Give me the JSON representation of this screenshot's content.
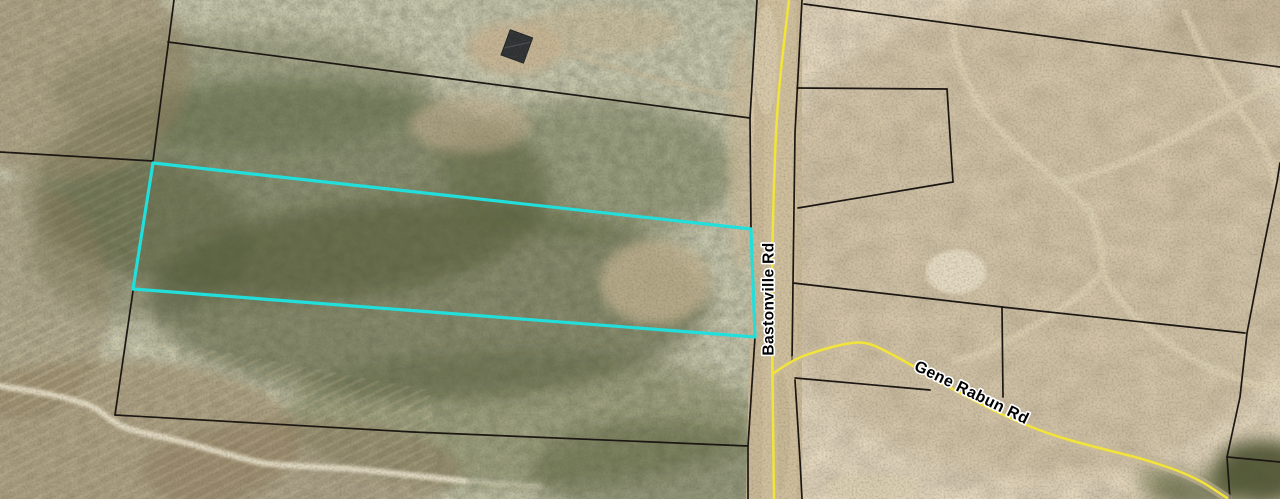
{
  "map": {
    "colors": {
      "parcel_line": "#1c1712",
      "highlight": "#22dfdc",
      "road_centerline": "#f2e438",
      "road_casing": "#cbbb9a"
    },
    "labels": [
      {
        "text": "Bastonville Rd",
        "x": 768,
        "y": 299,
        "rotation": -90,
        "font_size": 15.5
      },
      {
        "text": "Gene Rabun Rd",
        "x": 972,
        "y": 392,
        "rotation": 26,
        "font_size": 16
      }
    ],
    "highlight_parcel": {
      "points": [
        [
          153,
          163
        ],
        [
          751,
          229
        ],
        [
          755,
          337
        ],
        [
          133,
          289
        ]
      ],
      "closed": true
    },
    "parcel_lines": [
      {
        "name": "boundary-nw-vertical",
        "points": [
          [
            174,
            0
          ],
          [
            153,
            161
          ]
        ]
      },
      {
        "name": "boundary-west-horizontal",
        "points": [
          [
            0,
            152
          ],
          [
            153,
            161
          ]
        ]
      },
      {
        "name": "boundary-north",
        "points": [
          [
            168,
            42
          ],
          [
            460,
            80
          ],
          [
            750,
            118
          ]
        ]
      },
      {
        "name": "road-edge-west",
        "points": [
          [
            757,
            0
          ],
          [
            750,
            118
          ],
          [
            751,
            229
          ],
          [
            755,
            337
          ],
          [
            748,
            446
          ],
          [
            748,
            499
          ]
        ]
      },
      {
        "name": "big-parcel-west",
        "points": [
          [
            133,
            291
          ],
          [
            115,
            415
          ]
        ]
      },
      {
        "name": "big-parcel-south",
        "points": [
          [
            115,
            415
          ],
          [
            413,
            432
          ],
          [
            748,
            446
          ]
        ]
      },
      {
        "name": "road-edge-east-north",
        "points": [
          [
            802,
            0
          ],
          [
            795,
            133
          ],
          [
            793,
            283
          ],
          [
            792,
            362
          ]
        ]
      },
      {
        "name": "road-edge-east-south",
        "points": [
          [
            795,
            380
          ],
          [
            800,
            460
          ],
          [
            802,
            499
          ]
        ]
      },
      {
        "name": "boundary-ne-diagonal",
        "points": [
          [
            804,
            4
          ],
          [
            1090,
            42
          ],
          [
            1280,
            67
          ]
        ]
      },
      {
        "name": "east-parcel-north",
        "points": [
          [
            797,
            88
          ],
          [
            947,
            89
          ]
        ]
      },
      {
        "name": "east-parcel-east",
        "points": [
          [
            947,
            89
          ],
          [
            953,
            182
          ]
        ]
      },
      {
        "name": "east-parcel-south",
        "points": [
          [
            953,
            182
          ],
          [
            798,
            208
          ]
        ]
      },
      {
        "name": "east-mid-horizontal",
        "points": [
          [
            793,
            283
          ],
          [
            1002,
            307
          ],
          [
            1245,
            333
          ]
        ]
      },
      {
        "name": "east-mid-vertical-stub",
        "points": [
          [
            1002,
            307
          ],
          [
            1003,
            397
          ]
        ]
      },
      {
        "name": "east-right-vertical",
        "points": [
          [
            1280,
            163
          ],
          [
            1277,
            182
          ],
          [
            1263,
            250
          ],
          [
            1247,
            333
          ],
          [
            1240,
            397
          ],
          [
            1227,
            457
          ],
          [
            1230,
            499
          ]
        ]
      },
      {
        "name": "east-lower-stub",
        "points": [
          [
            795,
            378
          ],
          [
            930,
            390
          ]
        ]
      },
      {
        "name": "bottom-right-corner",
        "points": [
          [
            1227,
            457
          ],
          [
            1280,
            462
          ]
        ]
      }
    ],
    "roads": [
      {
        "name": "Bastonville Rd",
        "points": [
          [
            789,
            0
          ],
          [
            783,
            50
          ],
          [
            777,
            110
          ],
          [
            774,
            180
          ],
          [
            772,
            260
          ],
          [
            772,
            340
          ],
          [
            773,
            420
          ],
          [
            774,
            499
          ]
        ]
      },
      {
        "name": "Gene Rabun Rd",
        "points": [
          [
            774,
            373
          ],
          [
            792,
            360
          ],
          [
            820,
            350
          ],
          [
            848,
            343
          ],
          [
            866,
            342
          ],
          [
            884,
            350
          ],
          [
            915,
            367
          ],
          [
            950,
            388
          ],
          [
            1000,
            414
          ],
          [
            1048,
            434
          ],
          [
            1098,
            448
          ],
          [
            1148,
            460
          ],
          [
            1195,
            477
          ],
          [
            1227,
            498
          ]
        ]
      }
    ]
  }
}
